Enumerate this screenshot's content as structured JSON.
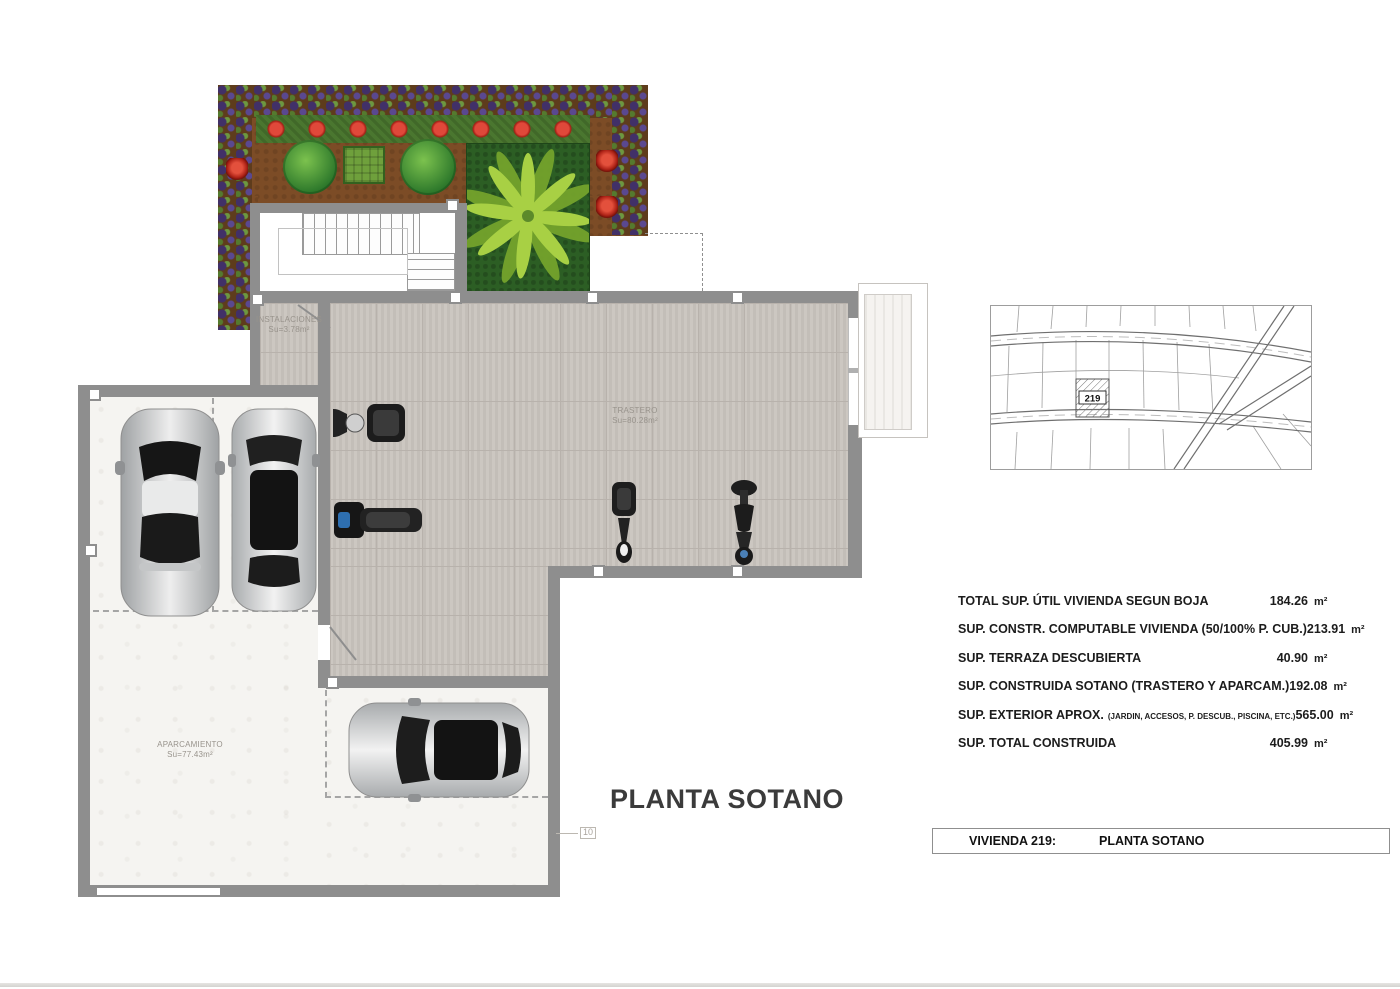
{
  "plan": {
    "title": "PLANTA SOTANO",
    "rooms": {
      "instalaciones": {
        "label": "INSTALACIONES",
        "area": "Su=3.78m²"
      },
      "trastero": {
        "label": "TRASTERO",
        "area": "Su=80.28m²"
      },
      "aparcamiento": {
        "label": "APARCAMIENTO",
        "area": "Su=77.43m²"
      }
    },
    "door_tag": "10"
  },
  "site_map": {
    "plot_label": "219"
  },
  "areas_table": {
    "rows": [
      {
        "label": "TOTAL SUP. ÚTIL VIVIENDA SEGUN BOJA",
        "sublabel": "",
        "value": "184.26",
        "unit": "m²"
      },
      {
        "label": "SUP. CONSTR. COMPUTABLE VIVIENDA (50/100% P. CUB.)",
        "sublabel": "",
        "value": "213.91",
        "unit": "m²"
      },
      {
        "label": "SUP. TERRAZA DESCUBIERTA",
        "sublabel": "",
        "value": "40.90",
        "unit": "m²"
      },
      {
        "label": "SUP. CONSTRUIDA SOTANO (TRASTERO Y APARCAM.)",
        "sublabel": "",
        "value": "192.08",
        "unit": "m²"
      },
      {
        "label": "SUP. EXTERIOR APROX.",
        "sublabel": "(JARDIN, ACCESOS, P. DESCUB., PISCINA, ETC.)",
        "value": "565.00",
        "unit": "m²"
      },
      {
        "label": "SUP. TOTAL CONSTRUIDA",
        "sublabel": "",
        "value": "405.99",
        "unit": "m²"
      }
    ]
  },
  "title_block": {
    "vivienda": "VIVIENDA 219:",
    "plano": "PLANTA SOTANO"
  },
  "colors": {
    "wall_gray": "#8e8e8e",
    "tile_floor": "#c9c4be",
    "garage_floor": "#f5f4f1",
    "garden_soil": "#7c4c26",
    "plant_purple": "#413068",
    "hedge_green": "#4a762f",
    "flower_red": "#e0483a",
    "palm_green": "#9cc840",
    "text_dark": "#1c1c1c"
  }
}
